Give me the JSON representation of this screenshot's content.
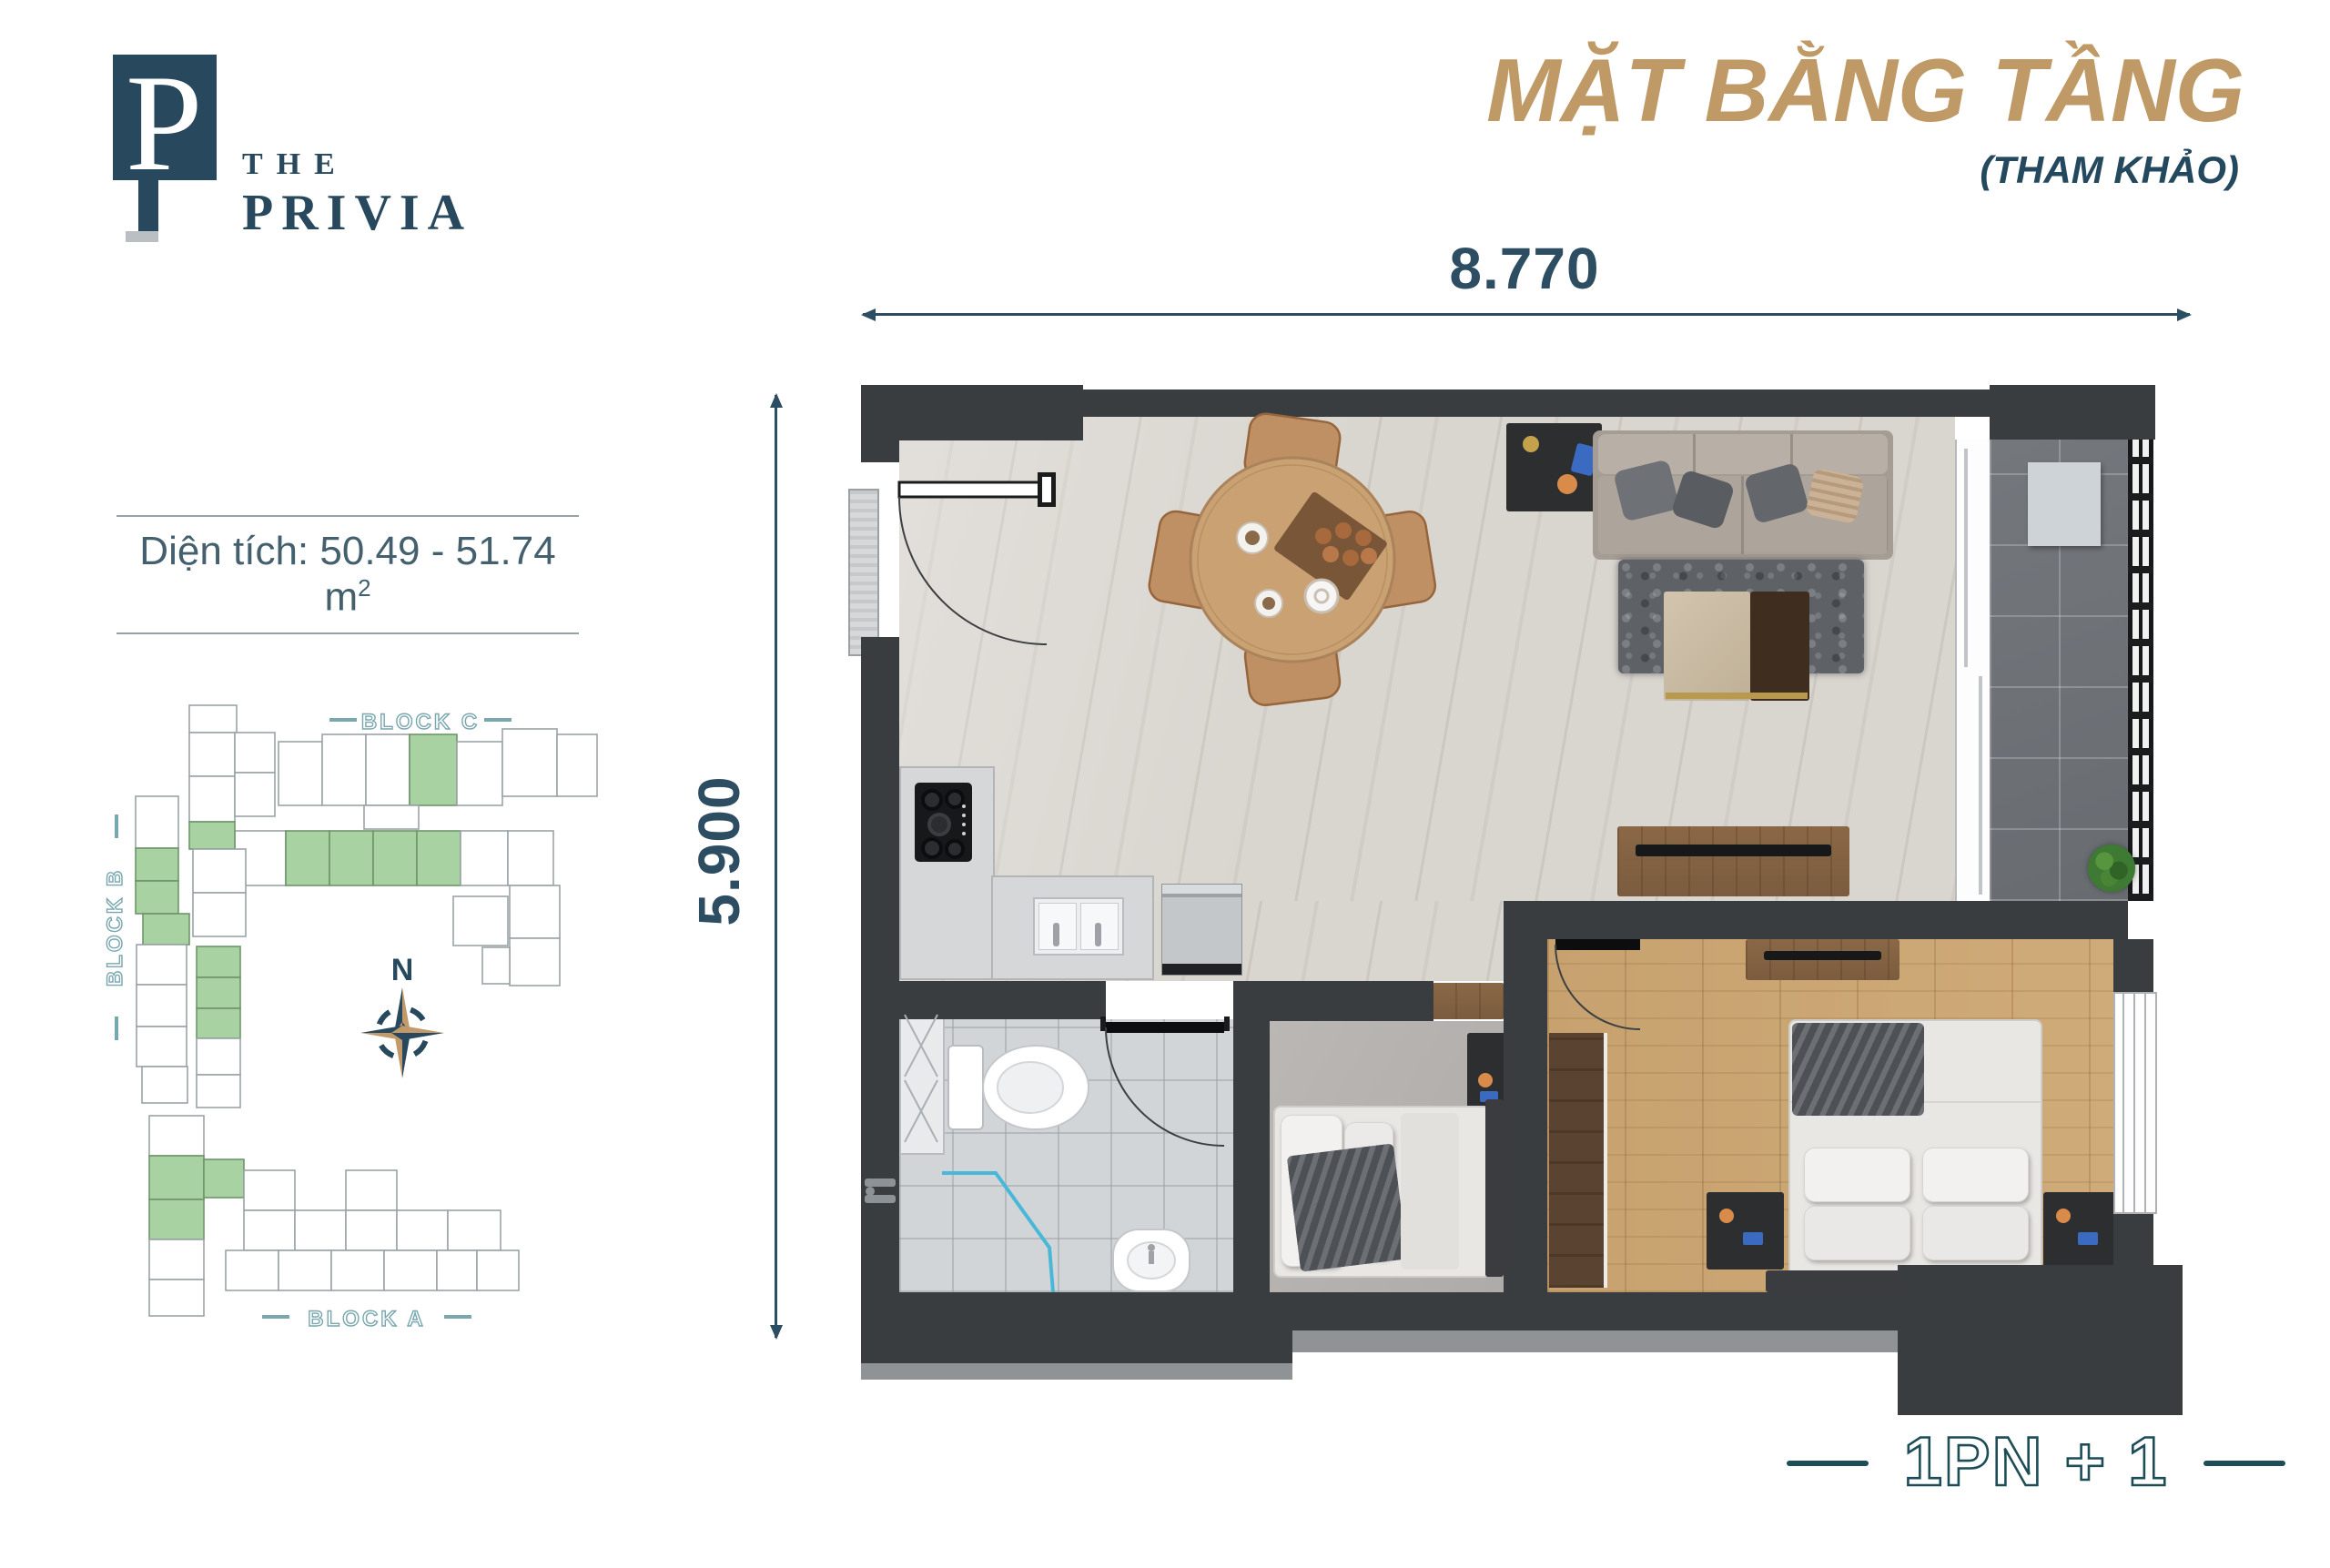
{
  "logo": {
    "monogram": "P",
    "the": "THE",
    "name": "PRIVIA"
  },
  "header": {
    "title": "MẶT BẰNG TẦNG",
    "subtitle": "(THAM KHẢO)"
  },
  "dimensions": {
    "width": "8.770",
    "height": "5.900"
  },
  "area": {
    "text": "Diện tích: 50.49 - 51.74 m",
    "sup": "2"
  },
  "site_map": {
    "block_b_label": "BLOCK B",
    "block_c_label": "BLOCK C",
    "block_a_label": "BLOCK A",
    "compass": "N"
  },
  "unit": {
    "type_label": "1PN + 1"
  },
  "theme": {
    "accent_gold": "#c09a66",
    "navy": "#27485d",
    "outline_teal": "#1d4d57",
    "map_teal": "#79a7ae",
    "highlight_green": "#a9d2a2",
    "wall": "#393d40",
    "travertine_floor": "#d9d5cf",
    "wood_floor": "#c9a473",
    "balcony_tile": "#6f7478"
  }
}
